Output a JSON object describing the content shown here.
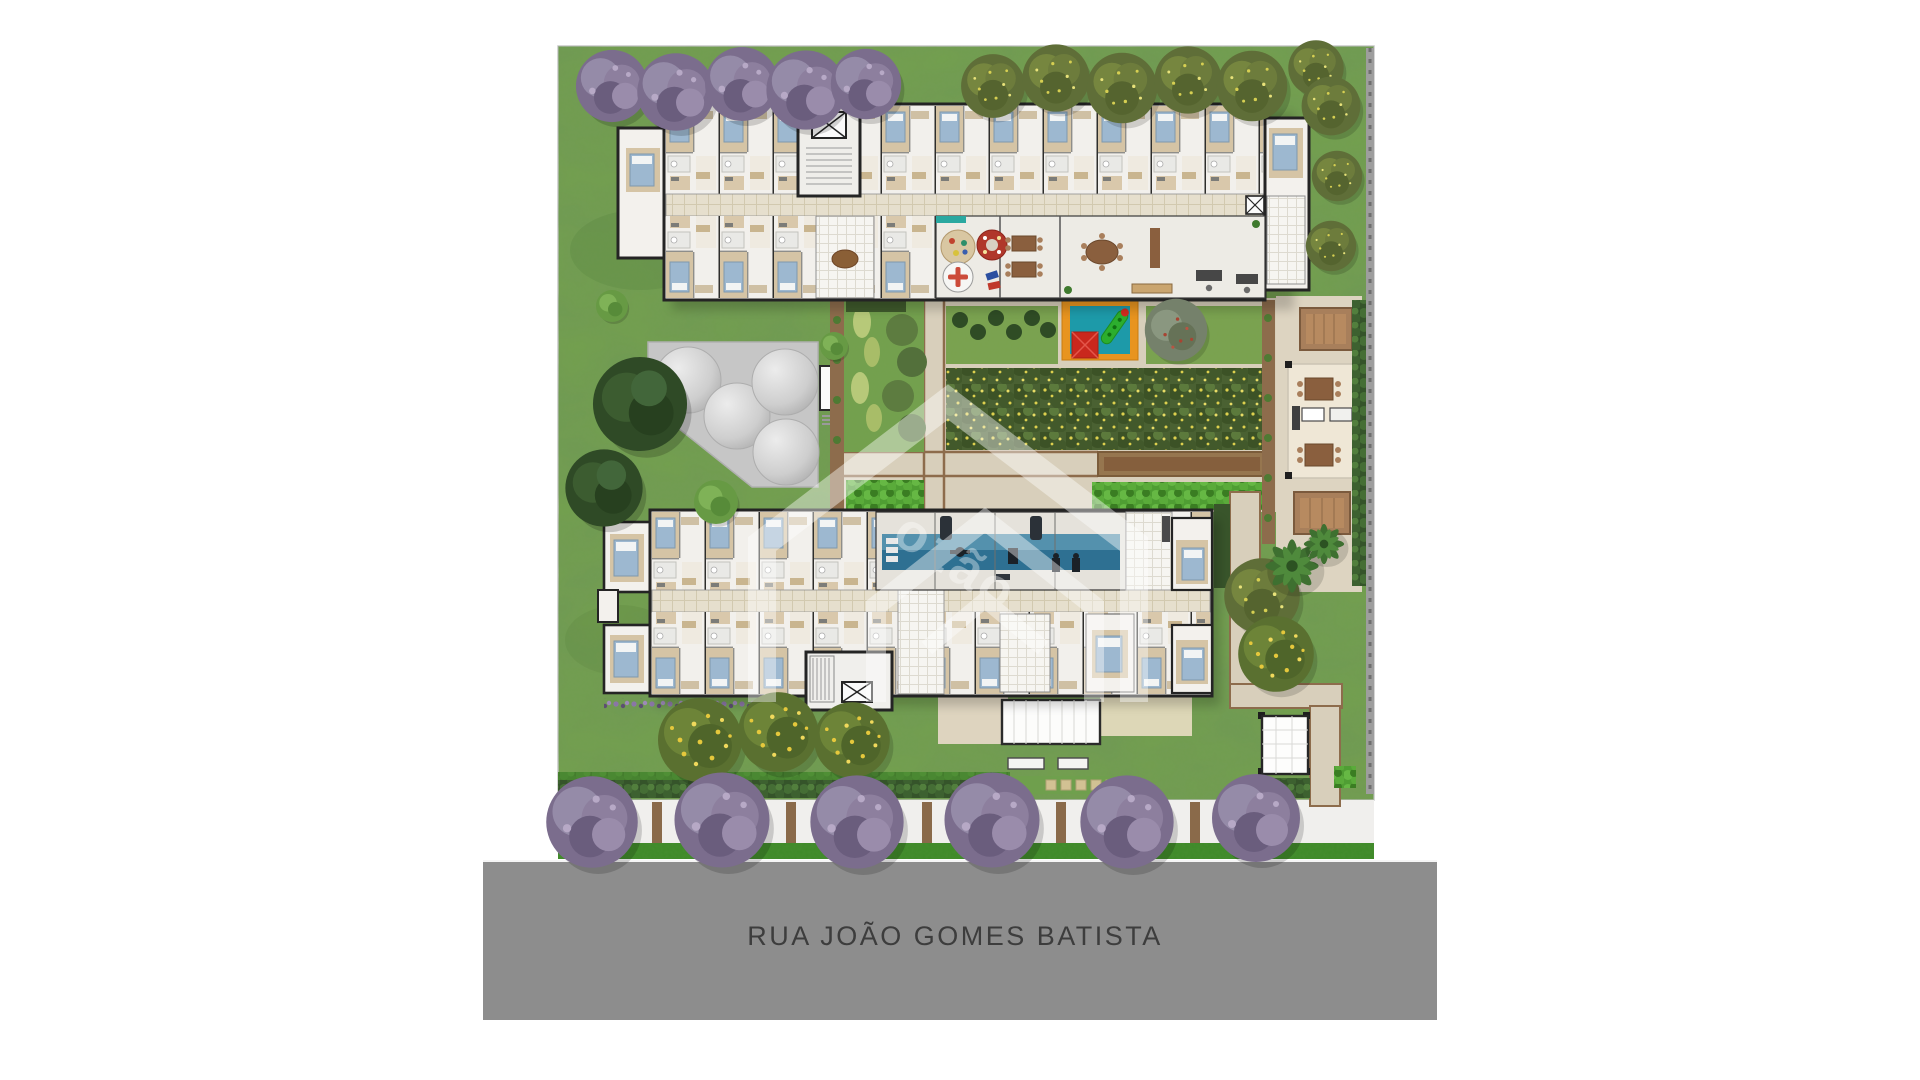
{
  "street": {
    "label": "RUA JOÃO GOMES BATISTA"
  },
  "watermark": {
    "text": "ozão"
  },
  "colors": {
    "page_bg": "#ffffff",
    "grass": "#73a04d",
    "grass_dark": "#567f38",
    "street": "#8d8d8d",
    "street_text": "#3d3d3d",
    "sidewalk": "#f0efed",
    "verge_green": "#3e8a28",
    "path": "#d8cfbb",
    "path_border": "#8d6c4c",
    "building_fill": "#f3f1ed",
    "wall": "#242424",
    "corridor": "#e6dfcd",
    "bed_blue": "#9db8d0",
    "gym_floor": "#2e7092",
    "playground_border": "#e8941f",
    "playground_mat": "#1d9aa9",
    "play_red": "#c9281d",
    "play_green": "#2cae2e",
    "pergola_brown": "#a87f5b",
    "tank_pad": "#c6c6c6",
    "hedge_bright": "#4f9e33",
    "hedge_dark": "#35542a",
    "tree_purple": "#7b6d8d",
    "tree_olive": "#5f6e38",
    "tree_yellow_flower": "#e5c83c",
    "planter_brown": "#8a6a4a",
    "game_table_red": "#b0372b",
    "amenity_teal": "#2aa8a0"
  }
}
